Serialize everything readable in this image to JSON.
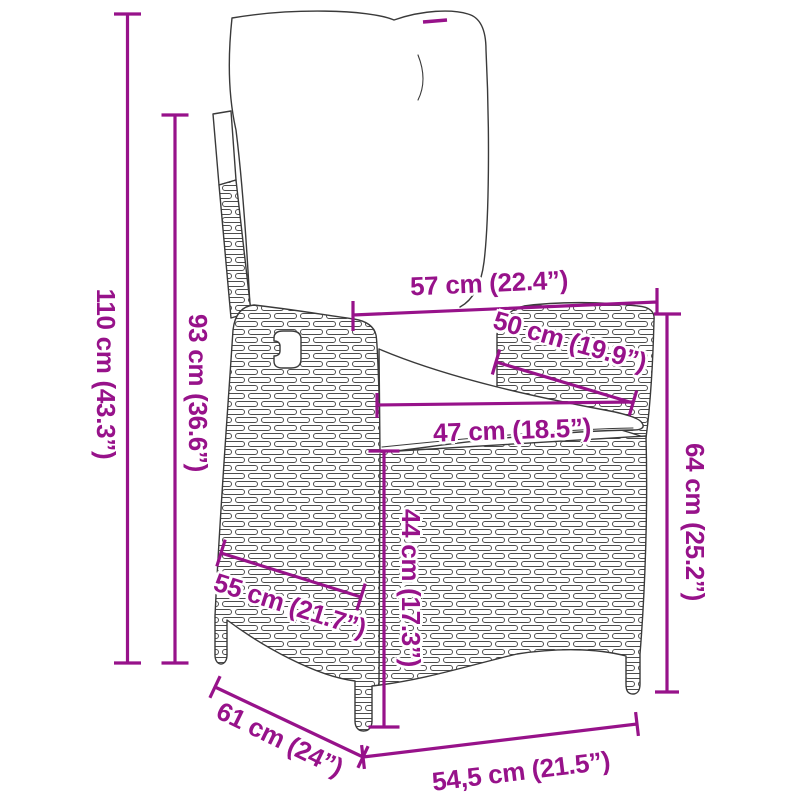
{
  "diagram": {
    "product": "reclining garden chair with cushions",
    "style": {
      "accent_color": "#97128a",
      "art_line_color": "#3a3a3a",
      "background": "#ffffff"
    },
    "dimensions": {
      "d110": {
        "label": "110 cm (43.3”)",
        "axis": "vertical"
      },
      "d93": {
        "label": "93 cm (36.6”)",
        "axis": "vertical"
      },
      "d57": {
        "label": "57 cm (22.4”)",
        "axis": "horizontal"
      },
      "d50": {
        "label": "50 cm (19.9”)",
        "axis": "diagonal"
      },
      "d47": {
        "label": "47 cm (18.5”)",
        "axis": "horizontal"
      },
      "d44": {
        "label": "44 cm (17.3”)",
        "axis": "vertical"
      },
      "d64": {
        "label": "64 cm (25.2”)",
        "axis": "vertical"
      },
      "d55": {
        "label": "55 cm (21.7”)",
        "axis": "diagonal"
      },
      "d61": {
        "label": "61 cm (24”)",
        "axis": "diagonal"
      },
      "d545": {
        "label": "54,5 cm (21.5”)",
        "axis": "horizontal"
      }
    }
  }
}
